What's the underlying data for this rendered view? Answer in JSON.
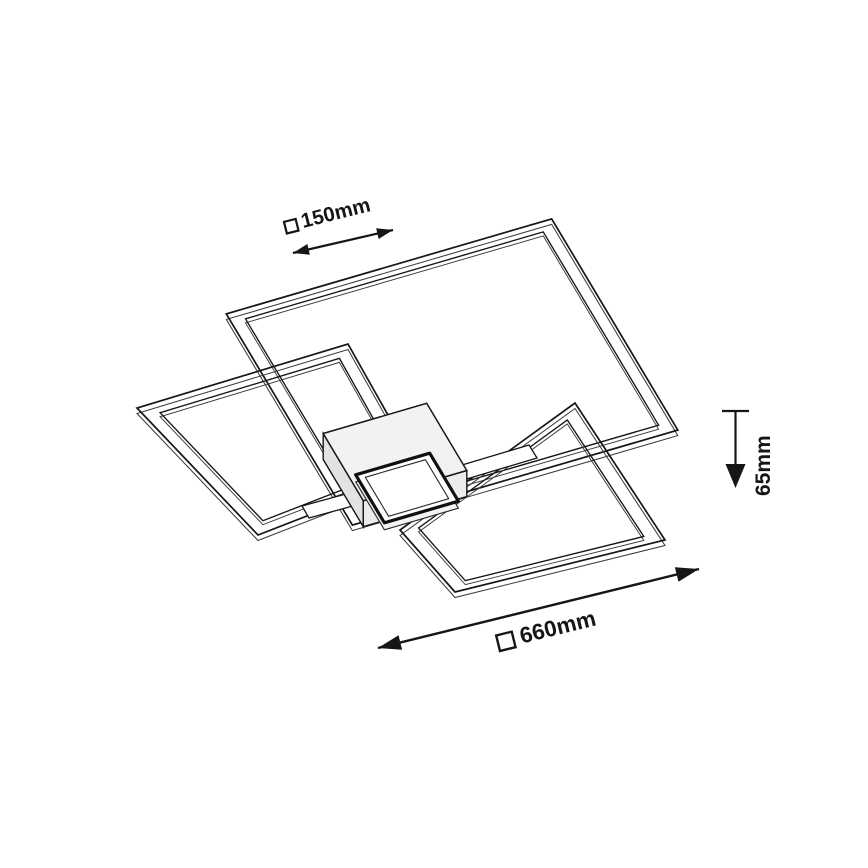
{
  "diagram": {
    "type": "isometric dimension drawing",
    "subject": "LED ceiling light with three square frames and central square canopy with LED panel",
    "background": "#ffffff",
    "colors": {
      "line": "#161616",
      "line_soft": "#3c3c3c",
      "hub_top": "#f2f2f2",
      "hub_side_left": "#e2e2e2",
      "hub_side_right": "#ececec",
      "panel_face": "#ffffff",
      "panel_depth_face": "#f4f4f4"
    },
    "dimensions": [
      {
        "id": "panel-size",
        "symbol": "square-symbol",
        "label": "150mm",
        "value_mm": 150,
        "orientation": "diagonal-top-left"
      },
      {
        "id": "fixture-height",
        "symbol": null,
        "label": "65mm",
        "value_mm": 65,
        "orientation": "vertical-right"
      },
      {
        "id": "overall-size",
        "symbol": "square-symbol",
        "label": "660mm",
        "value_mm": 660,
        "orientation": "diagonal-bottom"
      }
    ],
    "geometry": {
      "frames": [
        {
          "name": "frame-large",
          "outer": [
            [
              551.7,
              218.9
            ],
            [
              677.8,
              430.1
            ],
            [
              352.4,
              525.1
            ],
            [
              226.3,
              313.9
            ]
          ],
          "inner_scale": 0.915
        },
        {
          "name": "frame-left",
          "outer": [
            [
              348,
              344
            ],
            [
              420,
              472
            ],
            [
              258,
              535
            ],
            [
              137,
              408
            ]
          ],
          "inner_scale": 0.85
        },
        {
          "name": "frame-bottom-right",
          "outer": [
            [
              575,
              403
            ],
            [
              665,
              540
            ],
            [
              455,
              592
            ],
            [
              400,
              530
            ]
          ],
          "inner_scale": 0.85
        }
      ],
      "hub": {
        "top": [
          [
            426.7,
            403.3
          ],
          [
            466.8,
            470.5
          ],
          [
            363.3,
            500.7
          ],
          [
            323.2,
            433.5
          ]
        ],
        "depth": 26
      },
      "panel": {
        "outer": [
          [
            429.7,
            453.2
          ],
          [
            458.4,
            501.2
          ],
          [
            384.4,
            522.8
          ],
          [
            355.7,
            474.8
          ]
        ],
        "inner": [
          [
            425.4,
            459.7
          ],
          [
            448.7,
            498.7
          ],
          [
            388.6,
            516.3
          ],
          [
            365.3,
            477.3
          ]
        ],
        "depth": 7
      },
      "arms": [
        {
          "name": "arm-left",
          "quad": [
            [
              302,
              506
            ],
            [
              364,
              489
            ],
            [
              371,
              501
            ],
            [
              309,
              518
            ]
          ]
        },
        {
          "name": "arm-right",
          "quad": [
            [
              452,
              468
            ],
            [
              529,
              445
            ],
            [
              537,
              458
            ],
            [
              460,
              481
            ]
          ]
        }
      ],
      "arrows": {
        "dim150": {
          "from": [
            293,
            253
          ],
          "to": [
            393,
            230
          ],
          "head_len": 16,
          "head_w": 11,
          "width": 2.2
        },
        "dim660": {
          "from": [
            378,
            648
          ],
          "to": [
            699,
            569
          ],
          "head_len": 23,
          "head_w": 15,
          "width": 2.4
        },
        "dim65": {
          "tick": [
            [
              722,
              411
            ],
            [
              749,
              411
            ]
          ],
          "line": [
            [
              735.5,
              411
            ],
            [
              735.5,
              465
            ]
          ],
          "head_tip": [
            735.5,
            488
          ],
          "head_len": 24,
          "head_w": 20,
          "width": 2.2
        }
      }
    }
  }
}
